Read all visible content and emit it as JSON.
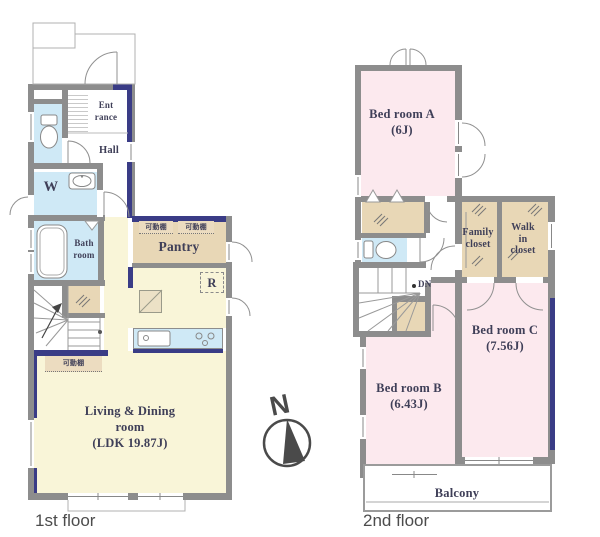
{
  "colors": {
    "wall_gray": "#8d8d8d",
    "accent_navy": "#3a3c86",
    "bedroom_pink": "#fce9ee",
    "ldk_yellow": "#f9f5d8",
    "wet_area_blue": "#cfe9f6",
    "closet_tan": "#e8d7b6",
    "label_ink": "#3f3f58"
  },
  "compass": {
    "letter": "N"
  },
  "floor1": {
    "caption": "1st floor",
    "labels": {
      "entrance": "Ent\nrance",
      "hall": "Hall",
      "washroom": "W",
      "bathroom": "Bath\nroom",
      "pantry": "Pantry",
      "shelf_a": "可動棚",
      "shelf_b": "可動棚",
      "shelf_c": "可動棚",
      "refrigerator": "R",
      "ldk": "Living & Dining\nroom\n(LDK 19.87J)"
    }
  },
  "floor2": {
    "caption": "2nd floor",
    "labels": {
      "bed_a": "Bed room A\n(6J)",
      "bed_b": "Bed room B\n(6.43J)",
      "bed_c": "Bed room C\n(7.56J)",
      "family_closet": "Family\ncloset",
      "walk_in_closet": "Walk\nin\ncloset",
      "down": "DN",
      "balcony": "Balcony"
    }
  }
}
